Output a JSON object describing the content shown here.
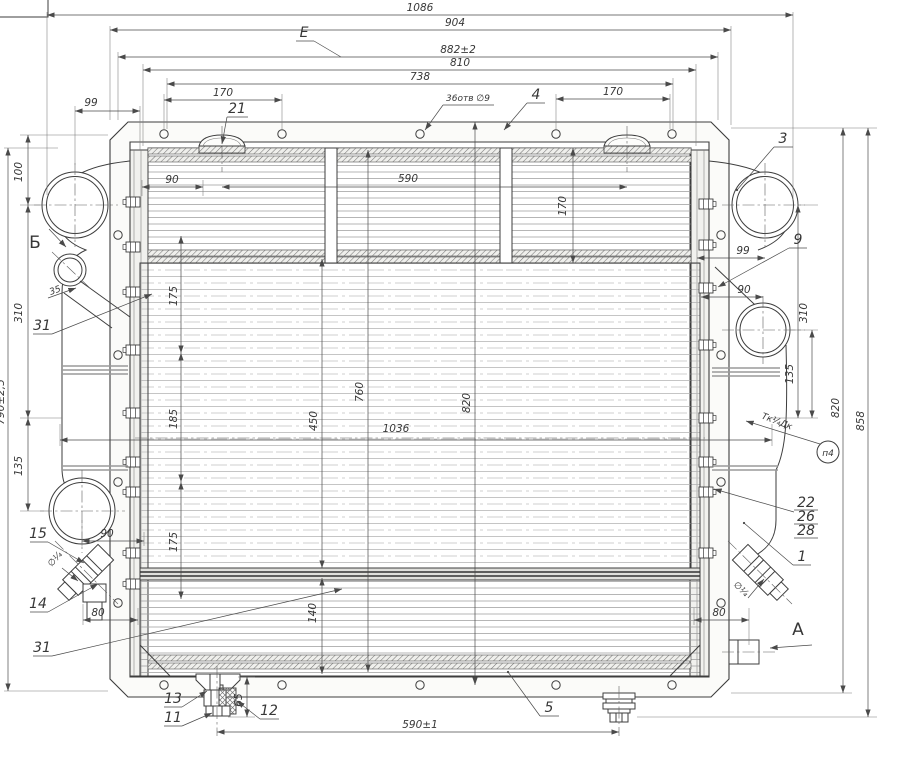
{
  "drawing": {
    "kind": "engineering-assembly-drawing",
    "subject": "radiator assembly, front view",
    "colors": {
      "line": "#3d3d3d",
      "dim_line": "#4a4a4a",
      "background": "#ffffff",
      "hatch": "#777777"
    }
  },
  "labels": [
    {
      "name": "dim-1086",
      "text": "1086"
    },
    {
      "name": "dim-904",
      "text": "904"
    },
    {
      "name": "ref-e",
      "text": "E"
    },
    {
      "name": "dim-882",
      "text": "882±2"
    },
    {
      "name": "dim-810",
      "text": "810"
    },
    {
      "name": "dim-738",
      "text": "738"
    },
    {
      "name": "dim-170-top-left",
      "text": "170"
    },
    {
      "name": "note-holes",
      "text": "36отв ∅9"
    },
    {
      "name": "callout-4",
      "text": "4"
    },
    {
      "name": "dim-170-top-right",
      "text": "170"
    },
    {
      "name": "dim-99-top-left",
      "text": "99"
    },
    {
      "name": "callout-21",
      "text": "21"
    },
    {
      "name": "dim-100-left",
      "text": "100"
    },
    {
      "name": "view-b",
      "text": "Б"
    },
    {
      "name": "dim-35-left",
      "text": "35"
    },
    {
      "name": "callout-31-upper",
      "text": "31"
    },
    {
      "name": "dim-310-left",
      "text": "310"
    },
    {
      "name": "dim-790",
      "text": "790±2,5"
    },
    {
      "name": "dim-135-left",
      "text": "135"
    },
    {
      "name": "callout-15",
      "text": "15"
    },
    {
      "name": "note-quarter-left",
      "text": "∅¼"
    },
    {
      "name": "callout-14",
      "text": "14"
    },
    {
      "name": "dim-90-left-lower",
      "text": "90"
    },
    {
      "name": "dim-80-left",
      "text": "80"
    },
    {
      "name": "callout-31-lower",
      "text": "31"
    },
    {
      "name": "callout-13",
      "text": "13"
    },
    {
      "name": "callout-11",
      "text": "11"
    },
    {
      "name": "dim-65",
      "text": "65"
    },
    {
      "name": "callout-12",
      "text": "12"
    },
    {
      "name": "dim-590-bottom",
      "text": "590±1"
    },
    {
      "name": "callout-5",
      "text": "5"
    },
    {
      "name": "callout-3",
      "text": "3"
    },
    {
      "name": "dim-99-right",
      "text": "99"
    },
    {
      "name": "callout-9",
      "text": "9"
    },
    {
      "name": "dim-90-right",
      "text": "90"
    },
    {
      "name": "dim-310-right",
      "text": "310"
    },
    {
      "name": "dim-135-right",
      "text": "135"
    },
    {
      "name": "note-thread",
      "text": "Тк¼Дк"
    },
    {
      "name": "ref-p4",
      "text": "п4"
    },
    {
      "name": "dim-820-right",
      "text": "820"
    },
    {
      "name": "dim-858",
      "text": "858"
    },
    {
      "name": "callout-22",
      "text": "22"
    },
    {
      "name": "callout-26",
      "text": "26"
    },
    {
      "name": "callout-28",
      "text": "28"
    },
    {
      "name": "callout-1",
      "text": "1"
    },
    {
      "name": "note-quarter-right",
      "text": "∅¼"
    },
    {
      "name": "dim-80-right",
      "text": "80"
    },
    {
      "name": "view-a",
      "text": "A"
    },
    {
      "name": "dim-90-core",
      "text": "90"
    },
    {
      "name": "dim-590-core",
      "text": "590"
    },
    {
      "name": "dim-170-core",
      "text": "170"
    },
    {
      "name": "dim-175-upper",
      "text": "175"
    },
    {
      "name": "dim-185",
      "text": "185"
    },
    {
      "name": "dim-175-lower",
      "text": "175"
    },
    {
      "name": "dim-450",
      "text": "450"
    },
    {
      "name": "dim-140",
      "text": "140"
    },
    {
      "name": "dim-760",
      "text": "760"
    },
    {
      "name": "dim-820-core",
      "text": "820"
    },
    {
      "name": "dim-1036",
      "text": "1036"
    }
  ]
}
